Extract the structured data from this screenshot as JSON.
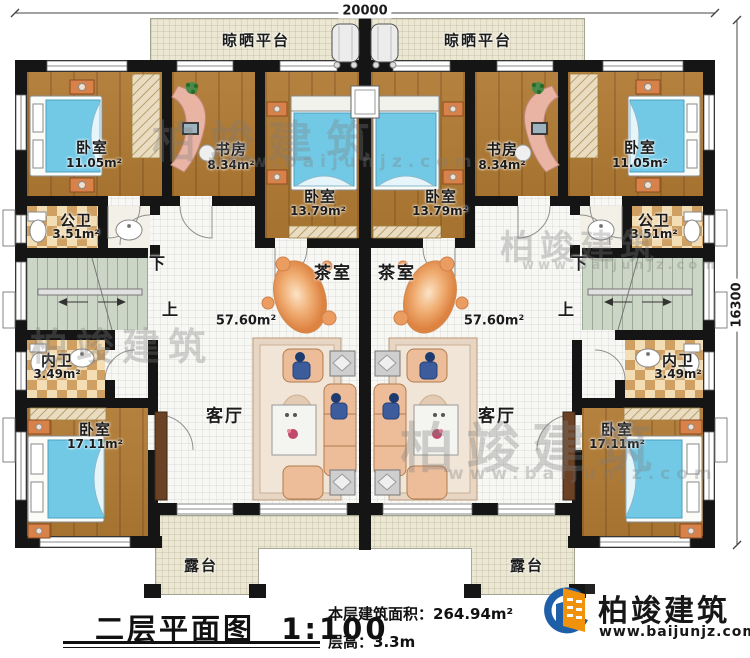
{
  "dimensions": {
    "top_width": "20000",
    "right_height": "16300"
  },
  "stairs": {
    "down": "下",
    "up": "上"
  },
  "rooms": {
    "platform": "晾晒平台",
    "terrace": "露台",
    "tea_room": "茶室",
    "living_room": "客厅",
    "hall_area": "57.60m²",
    "bedroom": "卧室",
    "study": "书房",
    "public_bath": "公卫",
    "private_bath": "内卫",
    "areas": {
      "bedroom_top": "11.05m²",
      "study": "8.34m²",
      "bedroom_mid": "13.79m²",
      "public_bath": "3.51m²",
      "private_bath": "3.49m²",
      "bedroom_bottom": "17.11m²"
    }
  },
  "title_block": {
    "title": "二层平面图",
    "scale": "1:100",
    "area_label": "本层建筑面积：",
    "area_value": "264.94m²",
    "height_label": "层高：",
    "height_value": "3.3m"
  },
  "logo": {
    "brand": "柏竣建筑",
    "site": "www.baijunjz.com"
  },
  "watermark": {
    "brand": "柏竣建筑",
    "site": "www.baijunjz.com"
  }
}
